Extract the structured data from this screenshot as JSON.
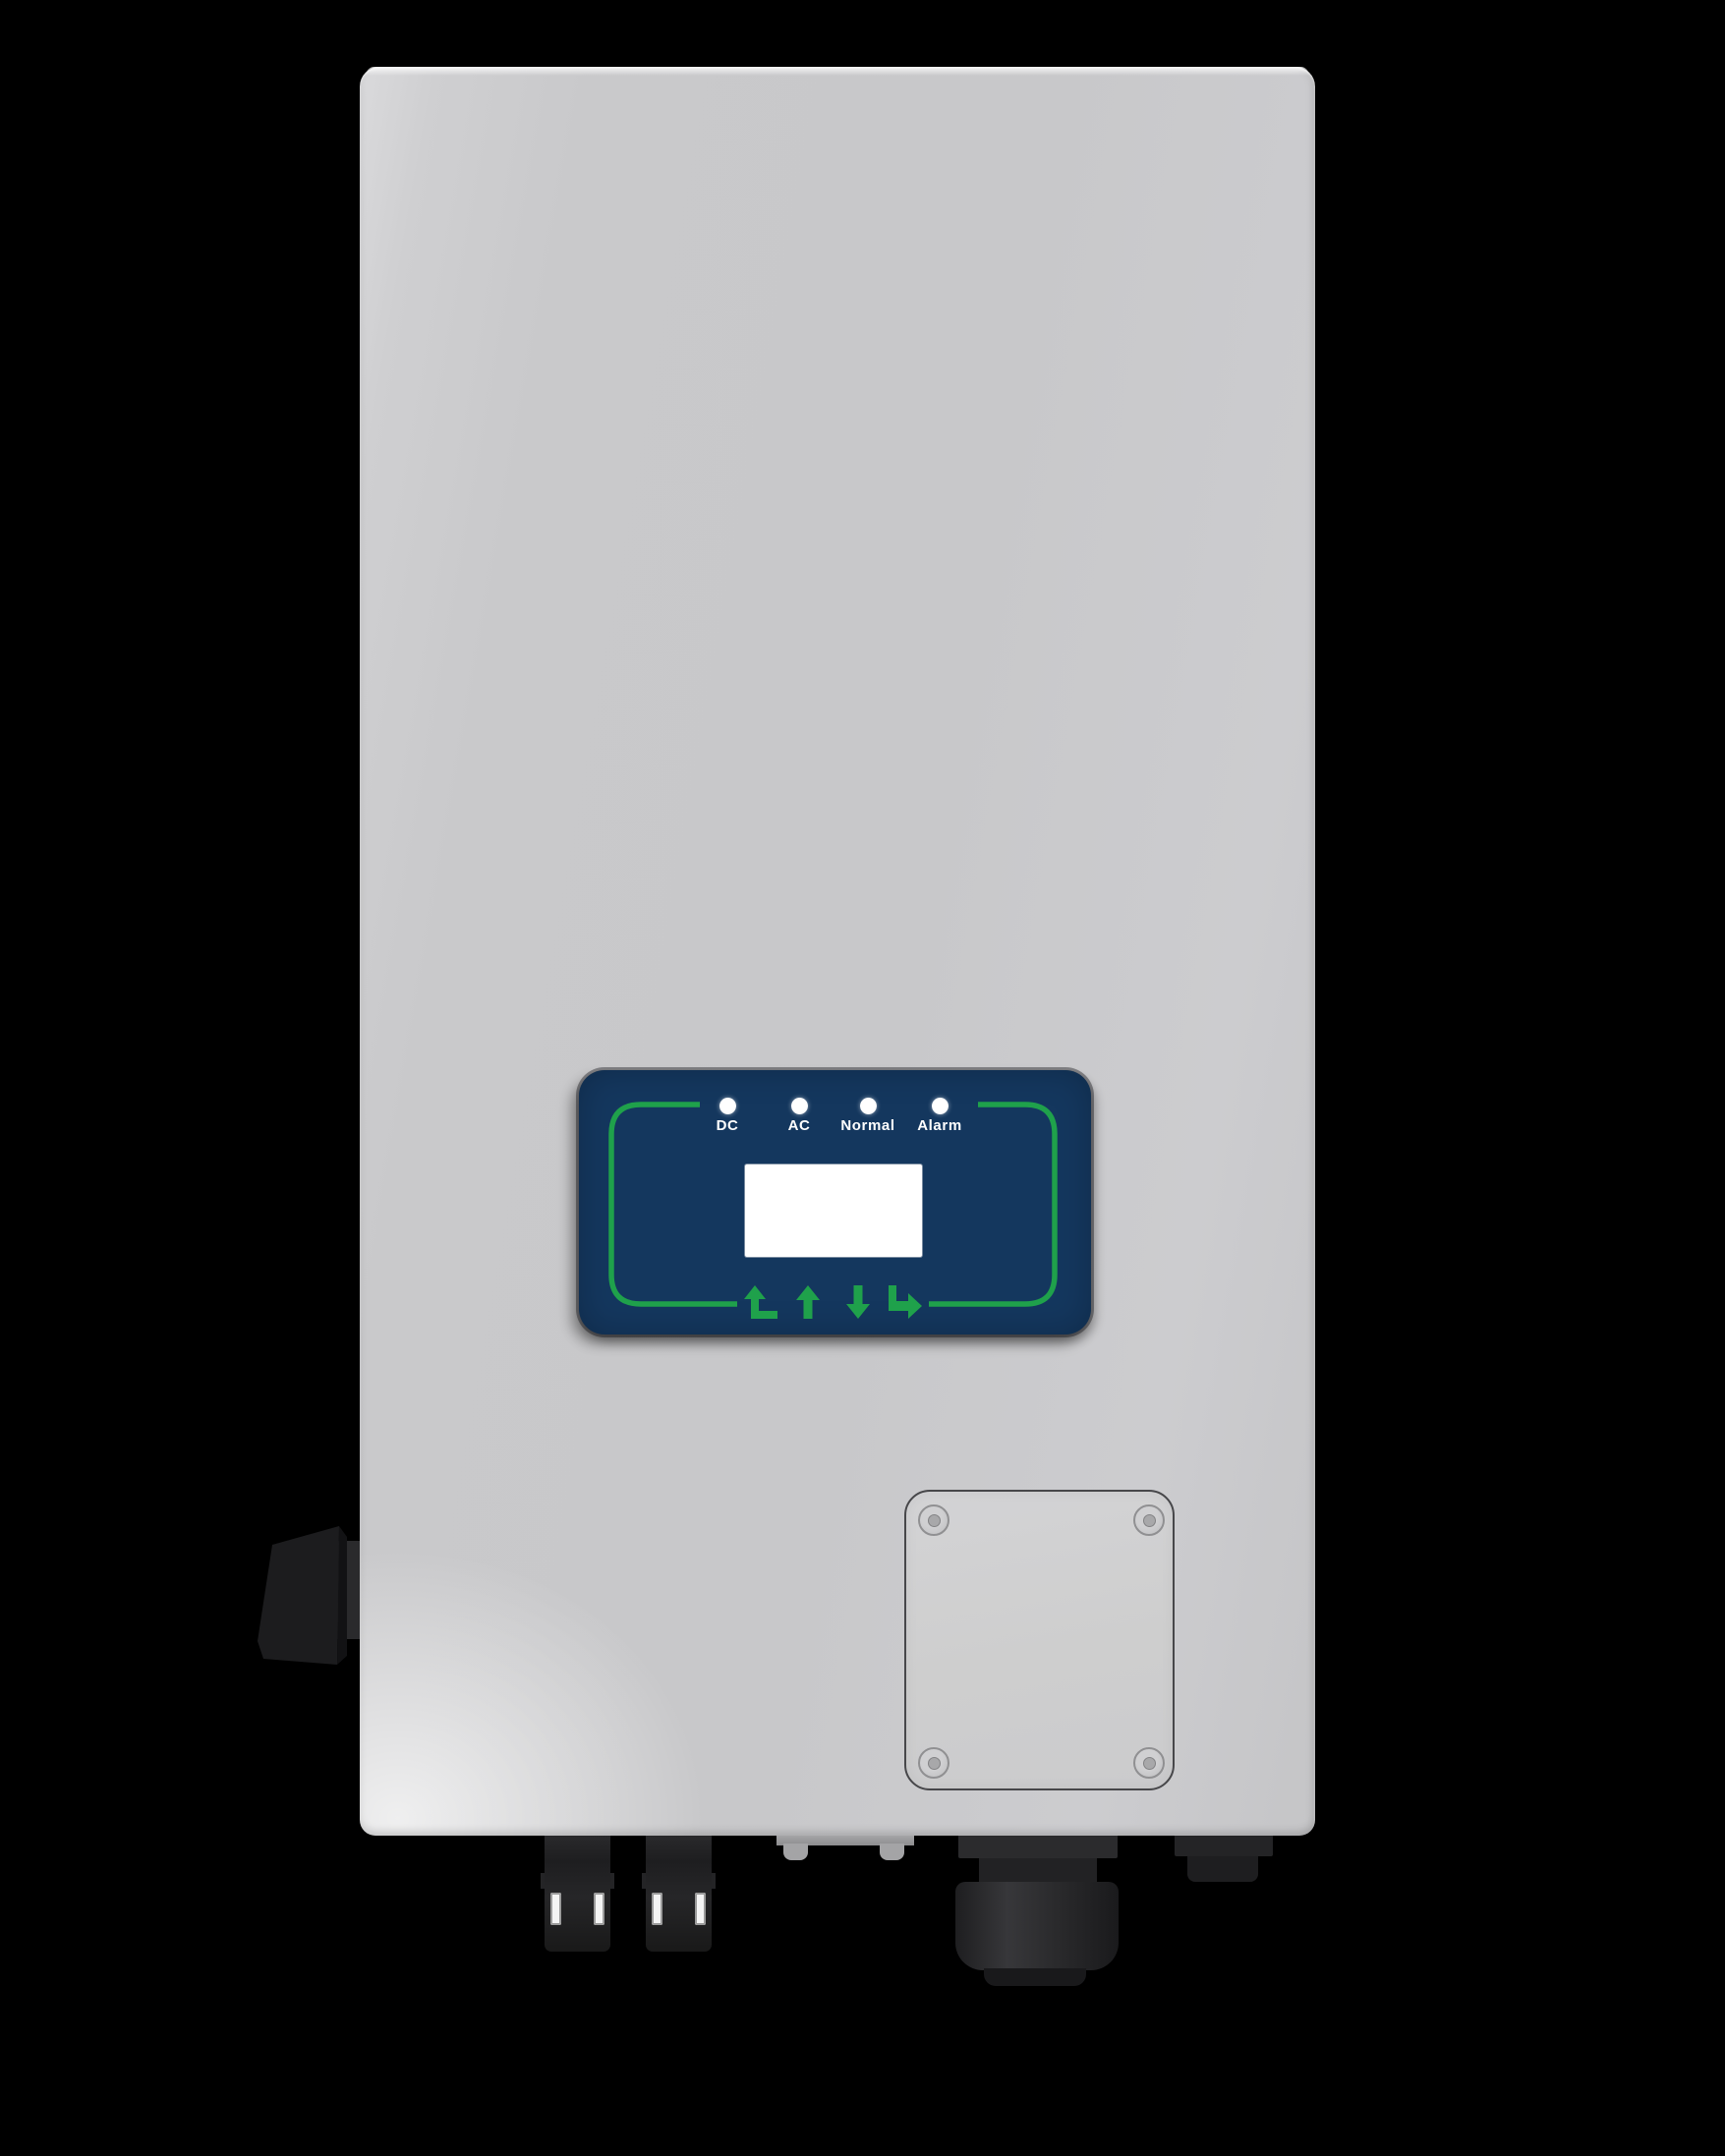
{
  "colors": {
    "background": "#000000",
    "body_gray": "#cbcbcd",
    "panel_navy": "#14375e",
    "accent_green": "#1fa14b",
    "led_white": "#ffffff",
    "hardware_black": "#202022"
  },
  "display_panel": {
    "leds": [
      {
        "label": "DC"
      },
      {
        "label": "AC"
      },
      {
        "label": "Normal"
      },
      {
        "label": "Alarm"
      }
    ],
    "screen": {
      "content": ""
    },
    "keys": [
      {
        "name": "back",
        "icon": "back-arrow-icon"
      },
      {
        "name": "up",
        "icon": "up-arrow-icon"
      },
      {
        "name": "down",
        "icon": "down-arrow-icon"
      },
      {
        "name": "enter",
        "icon": "enter-arrow-icon"
      }
    ]
  }
}
